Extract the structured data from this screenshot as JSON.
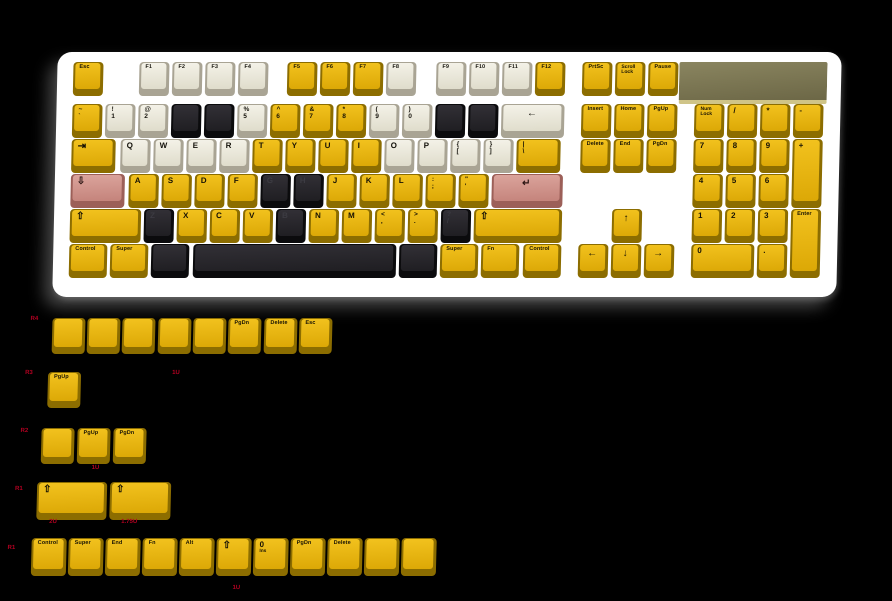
{
  "colors": {
    "yellow": "#e8b80d",
    "white": "#efede2",
    "black": "#26262a",
    "pink": "#d4938b",
    "case": "#ffffff",
    "badge_olive": "#7c774f",
    "badge_edge": "#cfc488",
    "label_red": "#b30021",
    "background": "#000000"
  },
  "keyboard": {
    "keys": [
      {
        "i": "esc",
        "x": 10,
        "y": 8,
        "w": 30,
        "c": "y",
        "l": "Esc",
        "t": "w"
      },
      {
        "i": "f1",
        "x": 76,
        "y": 8,
        "w": 30,
        "c": "w",
        "l": "F1",
        "t": "w"
      },
      {
        "i": "f2",
        "x": 109,
        "y": 8,
        "w": 30,
        "c": "w",
        "l": "F2",
        "t": "w"
      },
      {
        "i": "f3",
        "x": 142,
        "y": 8,
        "w": 30,
        "c": "w",
        "l": "F3",
        "t": "w"
      },
      {
        "i": "f4",
        "x": 175,
        "y": 8,
        "w": 30,
        "c": "w",
        "l": "F4",
        "t": "w"
      },
      {
        "i": "f5",
        "x": 224,
        "y": 8,
        "w": 30,
        "c": "y",
        "l": "F5",
        "t": "w"
      },
      {
        "i": "f6",
        "x": 257,
        "y": 8,
        "w": 30,
        "c": "y",
        "l": "F6",
        "t": "w"
      },
      {
        "i": "f7",
        "x": 290,
        "y": 8,
        "w": 30,
        "c": "y",
        "l": "F7",
        "t": "w"
      },
      {
        "i": "f8",
        "x": 323,
        "y": 8,
        "w": 30,
        "c": "w",
        "l": "F8",
        "t": "w"
      },
      {
        "i": "f9",
        "x": 373,
        "y": 8,
        "w": 30,
        "c": "w",
        "l": "F9",
        "t": "w"
      },
      {
        "i": "f10",
        "x": 406,
        "y": 8,
        "w": 30,
        "c": "w",
        "l": "F10",
        "t": "w"
      },
      {
        "i": "f11",
        "x": 439,
        "y": 8,
        "w": 30,
        "c": "w",
        "l": "F11",
        "t": "w"
      },
      {
        "i": "f12",
        "x": 472,
        "y": 8,
        "w": 30,
        "c": "y",
        "l": "F12",
        "t": "w"
      },
      {
        "i": "grave",
        "x": 10,
        "y": 50,
        "w": 30,
        "c": "y",
        "l": "~",
        "s": "`",
        "t": "d"
      },
      {
        "i": "1",
        "x": 43,
        "y": 50,
        "w": 30,
        "c": "w",
        "l": "!",
        "s": "1",
        "t": "d"
      },
      {
        "i": "2",
        "x": 76,
        "y": 50,
        "w": 30,
        "c": "w",
        "l": "@",
        "s": "2",
        "t": "d"
      },
      {
        "i": "3",
        "x": 109,
        "y": 50,
        "w": 30,
        "c": "k",
        "l": ""
      },
      {
        "i": "4",
        "x": 142,
        "y": 50,
        "w": 30,
        "c": "k",
        "l": ""
      },
      {
        "i": "5",
        "x": 175,
        "y": 50,
        "w": 30,
        "c": "w",
        "l": "%",
        "s": "5",
        "t": "d"
      },
      {
        "i": "6",
        "x": 208,
        "y": 50,
        "w": 30,
        "c": "y",
        "l": "^",
        "s": "6",
        "t": "d"
      },
      {
        "i": "7",
        "x": 241,
        "y": 50,
        "w": 30,
        "c": "y",
        "l": "&",
        "s": "7",
        "t": "d"
      },
      {
        "i": "8",
        "x": 274,
        "y": 50,
        "w": 30,
        "c": "y",
        "l": "*",
        "s": "8",
        "t": "d"
      },
      {
        "i": "9",
        "x": 307,
        "y": 50,
        "w": 30,
        "c": "w",
        "l": "(",
        "s": "9",
        "t": "d"
      },
      {
        "i": "0",
        "x": 340,
        "y": 50,
        "w": 30,
        "c": "w",
        "l": ")",
        "s": "0",
        "t": "d"
      },
      {
        "i": "minus",
        "x": 373,
        "y": 50,
        "w": 30,
        "c": "k",
        "l": ""
      },
      {
        "i": "equals",
        "x": 406,
        "y": 50,
        "w": 30,
        "c": "k",
        "l": ""
      },
      {
        "i": "backspace",
        "x": 439,
        "y": 50,
        "w": 63,
        "c": "w",
        "l": "←",
        "t": "c"
      },
      {
        "i": "tab",
        "x": 10,
        "y": 85,
        "w": 44,
        "c": "y",
        "l": "⇥",
        "t": "g"
      },
      {
        "i": "q",
        "x": 59,
        "y": 85,
        "w": 30,
        "c": "w",
        "l": "Q"
      },
      {
        "i": "w",
        "x": 92,
        "y": 85,
        "w": 30,
        "c": "w",
        "l": "W"
      },
      {
        "i": "e",
        "x": 125,
        "y": 85,
        "w": 30,
        "c": "w",
        "l": "E"
      },
      {
        "i": "r",
        "x": 158,
        "y": 85,
        "w": 30,
        "c": "w",
        "l": "R"
      },
      {
        "i": "t",
        "x": 191,
        "y": 85,
        "w": 30,
        "c": "y",
        "l": "T"
      },
      {
        "i": "y",
        "x": 224,
        "y": 85,
        "w": 30,
        "c": "y",
        "l": "Y"
      },
      {
        "i": "u",
        "x": 257,
        "y": 85,
        "w": 30,
        "c": "y",
        "l": "U"
      },
      {
        "i": "i",
        "x": 290,
        "y": 85,
        "w": 30,
        "c": "y",
        "l": "I"
      },
      {
        "i": "o",
        "x": 323,
        "y": 85,
        "w": 30,
        "c": "w",
        "l": "O"
      },
      {
        "i": "p",
        "x": 356,
        "y": 85,
        "w": 30,
        "c": "w",
        "l": "P"
      },
      {
        "i": "lbracket",
        "x": 389,
        "y": 85,
        "w": 30,
        "c": "w",
        "l": "{",
        "s": "[",
        "t": "d"
      },
      {
        "i": "rbracket",
        "x": 422,
        "y": 85,
        "w": 30,
        "c": "w",
        "l": "}",
        "s": "]",
        "t": "d"
      },
      {
        "i": "backslash",
        "x": 455,
        "y": 85,
        "w": 44,
        "c": "y",
        "l": "|",
        "s": "\\",
        "t": "d"
      },
      {
        "i": "capslock",
        "x": 10,
        "y": 120,
        "w": 54,
        "c": "p",
        "l": "⇩",
        "t": "g"
      },
      {
        "i": "a",
        "x": 68,
        "y": 120,
        "w": 30,
        "c": "y",
        "l": "A"
      },
      {
        "i": "s",
        "x": 101,
        "y": 120,
        "w": 30,
        "c": "y",
        "l": "S"
      },
      {
        "i": "d",
        "x": 134,
        "y": 120,
        "w": 30,
        "c": "y",
        "l": "D"
      },
      {
        "i": "f",
        "x": 167,
        "y": 120,
        "w": 30,
        "c": "y",
        "l": "F"
      },
      {
        "i": "g",
        "x": 200,
        "y": 120,
        "w": 30,
        "c": "k",
        "l": "G",
        "m": 1
      },
      {
        "i": "h",
        "x": 233,
        "y": 120,
        "w": 30,
        "c": "k",
        "l": "H",
        "m": 1
      },
      {
        "i": "j",
        "x": 266,
        "y": 120,
        "w": 30,
        "c": "y",
        "l": "J"
      },
      {
        "i": "k",
        "x": 299,
        "y": 120,
        "w": 30,
        "c": "y",
        "l": "K"
      },
      {
        "i": "l",
        "x": 332,
        "y": 120,
        "w": 30,
        "c": "y",
        "l": "L"
      },
      {
        "i": "semicolon",
        "x": 365,
        "y": 120,
        "w": 30,
        "c": "y",
        "l": ":",
        "s": ";",
        "t": "d"
      },
      {
        "i": "quote",
        "x": 398,
        "y": 120,
        "w": 30,
        "c": "y",
        "l": "\"",
        "s": "'",
        "t": "d"
      },
      {
        "i": "enter",
        "x": 431,
        "y": 120,
        "w": 71,
        "c": "p",
        "l": "↵",
        "t": "c"
      },
      {
        "i": "lshift",
        "x": 10,
        "y": 155,
        "w": 71,
        "c": "y",
        "l": "⇧",
        "t": "g"
      },
      {
        "i": "z",
        "x": 84,
        "y": 155,
        "w": 30,
        "c": "k",
        "l": "Z",
        "m": 1
      },
      {
        "i": "x",
        "x": 117,
        "y": 155,
        "w": 30,
        "c": "y",
        "l": "X"
      },
      {
        "i": "c",
        "x": 150,
        "y": 155,
        "w": 30,
        "c": "y",
        "l": "C"
      },
      {
        "i": "v",
        "x": 183,
        "y": 155,
        "w": 30,
        "c": "y",
        "l": "V"
      },
      {
        "i": "b",
        "x": 216,
        "y": 155,
        "w": 30,
        "c": "k",
        "l": "B",
        "m": 1
      },
      {
        "i": "n",
        "x": 249,
        "y": 155,
        "w": 30,
        "c": "y",
        "l": "N"
      },
      {
        "i": "m",
        "x": 282,
        "y": 155,
        "w": 30,
        "c": "y",
        "l": "M"
      },
      {
        "i": "comma",
        "x": 315,
        "y": 155,
        "w": 30,
        "c": "y",
        "l": "<",
        "s": ",",
        "t": "d"
      },
      {
        "i": "period",
        "x": 348,
        "y": 155,
        "w": 30,
        "c": "y",
        "l": ">",
        "s": ".",
        "t": "d"
      },
      {
        "i": "slash",
        "x": 381,
        "y": 155,
        "w": 30,
        "c": "k",
        "l": "?",
        "s": "/",
        "t": "d",
        "m": 1
      },
      {
        "i": "rshift",
        "x": 414,
        "y": 155,
        "w": 88,
        "c": "y",
        "l": "⇧",
        "t": "g"
      },
      {
        "i": "lctrl",
        "x": 10,
        "y": 190,
        "w": 38,
        "c": "y",
        "l": "Control",
        "t": "w"
      },
      {
        "i": "lsuper",
        "x": 51,
        "y": 190,
        "w": 38,
        "c": "y",
        "l": "Super",
        "t": "w"
      },
      {
        "i": "lalt",
        "x": 92,
        "y": 190,
        "w": 38,
        "c": "k",
        "l": ""
      },
      {
        "i": "space",
        "x": 134,
        "y": 190,
        "w": 203,
        "c": "k",
        "l": ""
      },
      {
        "i": "ralt",
        "x": 340,
        "y": 190,
        "w": 38,
        "c": "k",
        "l": ""
      },
      {
        "i": "rsuper",
        "x": 381,
        "y": 190,
        "w": 38,
        "c": "y",
        "l": "Super",
        "t": "w"
      },
      {
        "i": "fn",
        "x": 422,
        "y": 190,
        "w": 38,
        "c": "y",
        "l": "Fn",
        "t": "w"
      },
      {
        "i": "rctrl",
        "x": 464,
        "y": 190,
        "w": 38,
        "c": "y",
        "l": "Control",
        "t": "w"
      },
      {
        "i": "prtsc",
        "x": 519,
        "y": 8,
        "w": 30,
        "c": "y",
        "l": "PrtSc",
        "t": "w"
      },
      {
        "i": "scrolllock",
        "x": 552,
        "y": 8,
        "w": 30,
        "c": "y",
        "l": "Scroll",
        "s": "Lock",
        "t": "e"
      },
      {
        "i": "pause",
        "x": 585,
        "y": 8,
        "w": 30,
        "c": "y",
        "l": "Pause",
        "t": "w"
      },
      {
        "i": "insert",
        "x": 519,
        "y": 50,
        "w": 30,
        "c": "y",
        "l": "Insert",
        "t": "w"
      },
      {
        "i": "home",
        "x": 552,
        "y": 50,
        "w": 30,
        "c": "y",
        "l": "Home",
        "t": "w"
      },
      {
        "i": "pgup",
        "x": 585,
        "y": 50,
        "w": 30,
        "c": "y",
        "l": "PgUp",
        "t": "w"
      },
      {
        "i": "delete",
        "x": 519,
        "y": 85,
        "w": 30,
        "c": "y",
        "l": "Delete",
        "t": "w"
      },
      {
        "i": "end",
        "x": 552,
        "y": 85,
        "w": 30,
        "c": "y",
        "l": "End",
        "t": "w"
      },
      {
        "i": "pgdn",
        "x": 585,
        "y": 85,
        "w": 30,
        "c": "y",
        "l": "PgDn",
        "t": "w"
      },
      {
        "i": "arrow-up",
        "x": 552,
        "y": 155,
        "w": 30,
        "c": "y",
        "l": "↑",
        "t": "c"
      },
      {
        "i": "arrow-left",
        "x": 519,
        "y": 190,
        "w": 30,
        "c": "y",
        "l": "←",
        "t": "c"
      },
      {
        "i": "arrow-down",
        "x": 552,
        "y": 190,
        "w": 30,
        "c": "y",
        "l": "↓",
        "t": "c"
      },
      {
        "i": "arrow-right",
        "x": 585,
        "y": 190,
        "w": 30,
        "c": "y",
        "l": "→",
        "t": "c"
      },
      {
        "i": "numlock",
        "x": 632,
        "y": 50,
        "w": 30,
        "c": "y",
        "l": "Num",
        "s": "Lock",
        "t": "e"
      },
      {
        "i": "np-divide",
        "x": 665,
        "y": 50,
        "w": 30,
        "c": "y",
        "l": "/"
      },
      {
        "i": "np-multiply",
        "x": 698,
        "y": 50,
        "w": 30,
        "c": "y",
        "l": "*"
      },
      {
        "i": "np-subtract",
        "x": 731,
        "y": 50,
        "w": 30,
        "c": "y",
        "l": "-"
      },
      {
        "i": "np7",
        "x": 632,
        "y": 85,
        "w": 30,
        "c": "y",
        "l": "7"
      },
      {
        "i": "np8",
        "x": 665,
        "y": 85,
        "w": 30,
        "c": "y",
        "l": "8"
      },
      {
        "i": "np9",
        "x": 698,
        "y": 85,
        "w": 30,
        "c": "y",
        "l": "9"
      },
      {
        "i": "np-add",
        "x": 731,
        "y": 85,
        "w": 30,
        "h": 69,
        "c": "y",
        "l": "+"
      },
      {
        "i": "np4",
        "x": 632,
        "y": 120,
        "w": 30,
        "c": "y",
        "l": "4"
      },
      {
        "i": "np5",
        "x": 665,
        "y": 120,
        "w": 30,
        "c": "y",
        "l": "5"
      },
      {
        "i": "np6",
        "x": 698,
        "y": 120,
        "w": 30,
        "c": "y",
        "l": "6"
      },
      {
        "i": "np1",
        "x": 632,
        "y": 155,
        "w": 30,
        "c": "y",
        "l": "1"
      },
      {
        "i": "np2",
        "x": 665,
        "y": 155,
        "w": 30,
        "c": "y",
        "l": "2"
      },
      {
        "i": "np3",
        "x": 698,
        "y": 155,
        "w": 30,
        "c": "y",
        "l": "3"
      },
      {
        "i": "np-enter",
        "x": 731,
        "y": 155,
        "w": 30,
        "h": 69,
        "c": "y",
        "l": "Enter",
        "t": "w"
      },
      {
        "i": "np0",
        "x": 632,
        "y": 190,
        "w": 63,
        "c": "y",
        "l": "0"
      },
      {
        "i": "np-dot",
        "x": 698,
        "y": 190,
        "w": 30,
        "c": "y",
        "l": "."
      }
    ]
  },
  "spares": {
    "keys": [
      {
        "i": "r4-blank1",
        "x": 53,
        "y": 318,
        "w": 33,
        "h": 36,
        "c": "y",
        "l": ""
      },
      {
        "i": "r4-blank2",
        "x": 88,
        "y": 318,
        "w": 33,
        "h": 36,
        "c": "y",
        "l": ""
      },
      {
        "i": "r4-blank3",
        "x": 123,
        "y": 318,
        "w": 33,
        "h": 36,
        "c": "y",
        "l": ""
      },
      {
        "i": "r4-blank4",
        "x": 159,
        "y": 318,
        "w": 33,
        "h": 36,
        "c": "y",
        "l": ""
      },
      {
        "i": "r4-blank5",
        "x": 194,
        "y": 318,
        "w": 33,
        "h": 36,
        "c": "y",
        "l": ""
      },
      {
        "i": "r4-pgdn",
        "x": 229,
        "y": 318,
        "w": 33,
        "h": 36,
        "c": "y",
        "l": "PgDn",
        "t": "w"
      },
      {
        "i": "r4-delete",
        "x": 265,
        "y": 318,
        "w": 33,
        "h": 36,
        "c": "y",
        "l": "Delete",
        "t": "w"
      },
      {
        "i": "r4-esc",
        "x": 300,
        "y": 318,
        "w": 33,
        "h": 36,
        "c": "y",
        "l": "Esc",
        "t": "w"
      },
      {
        "i": "r3-pgup",
        "x": 50,
        "y": 372,
        "w": 33,
        "h": 36,
        "c": "y",
        "l": "PgUp",
        "t": "w"
      },
      {
        "i": "r2-blank",
        "x": 45,
        "y": 428,
        "w": 33,
        "h": 36,
        "c": "y",
        "l": ""
      },
      {
        "i": "r2-pgup",
        "x": 81,
        "y": 428,
        "w": 33,
        "h": 36,
        "c": "y",
        "l": "PgUp",
        "t": "w"
      },
      {
        "i": "r2-pgdn",
        "x": 117,
        "y": 428,
        "w": 33,
        "h": 36,
        "c": "y",
        "l": "PgDn",
        "t": "w"
      },
      {
        "i": "r1-shift-2u",
        "x": 42,
        "y": 482,
        "w": 70,
        "h": 38,
        "c": "y",
        "l": "⇧",
        "t": "g"
      },
      {
        "i": "r1-shift-175u",
        "x": 115,
        "y": 482,
        "w": 61,
        "h": 38,
        "c": "y",
        "l": "⇧",
        "t": "g"
      },
      {
        "i": "b-control",
        "x": 38,
        "y": 538,
        "w": 35,
        "h": 38,
        "c": "y",
        "l": "Control",
        "t": "w"
      },
      {
        "i": "b-super",
        "x": 75,
        "y": 538,
        "w": 35,
        "h": 38,
        "c": "y",
        "l": "Super",
        "t": "w"
      },
      {
        "i": "b-end",
        "x": 112,
        "y": 538,
        "w": 35,
        "h": 38,
        "c": "y",
        "l": "End",
        "t": "w"
      },
      {
        "i": "b-fn",
        "x": 149,
        "y": 538,
        "w": 35,
        "h": 38,
        "c": "y",
        "l": "Fn",
        "t": "w"
      },
      {
        "i": "b-alt",
        "x": 186,
        "y": 538,
        "w": 35,
        "h": 38,
        "c": "y",
        "l": "Alt",
        "t": "w"
      },
      {
        "i": "b-shift",
        "x": 223,
        "y": 538,
        "w": 35,
        "h": 38,
        "c": "y",
        "l": "⇧",
        "t": "g"
      },
      {
        "i": "b-np0",
        "x": 260,
        "y": 538,
        "w": 35,
        "h": 38,
        "c": "y",
        "l": "0",
        "s": "Ins",
        "t": "n"
      },
      {
        "i": "b-pgdn",
        "x": 297,
        "y": 538,
        "w": 35,
        "h": 38,
        "c": "y",
        "l": "PgDn",
        "t": "w"
      },
      {
        "i": "b-delete",
        "x": 334,
        "y": 538,
        "w": 35,
        "h": 38,
        "c": "y",
        "l": "Delete",
        "t": "w"
      },
      {
        "i": "b-blank1",
        "x": 371,
        "y": 538,
        "w": 35,
        "h": 38,
        "c": "y",
        "l": ""
      },
      {
        "i": "b-blank2",
        "x": 408,
        "y": 538,
        "w": 35,
        "h": 38,
        "c": "y",
        "l": ""
      }
    ],
    "labels": [
      {
        "x": 31,
        "y": 316,
        "t": "R4"
      },
      {
        "x": 27,
        "y": 370,
        "t": "R3"
      },
      {
        "x": 174,
        "y": 370,
        "t": "1U"
      },
      {
        "x": 24,
        "y": 428,
        "t": "R2"
      },
      {
        "x": 96,
        "y": 465,
        "t": "1U"
      },
      {
        "x": 20,
        "y": 486,
        "t": "R1"
      },
      {
        "x": 55,
        "y": 519,
        "t": "2U"
      },
      {
        "x": 127,
        "y": 519,
        "t": "1.75U"
      },
      {
        "x": 14,
        "y": 545,
        "t": "R1"
      },
      {
        "x": 240,
        "y": 585,
        "t": "1U"
      }
    ]
  }
}
